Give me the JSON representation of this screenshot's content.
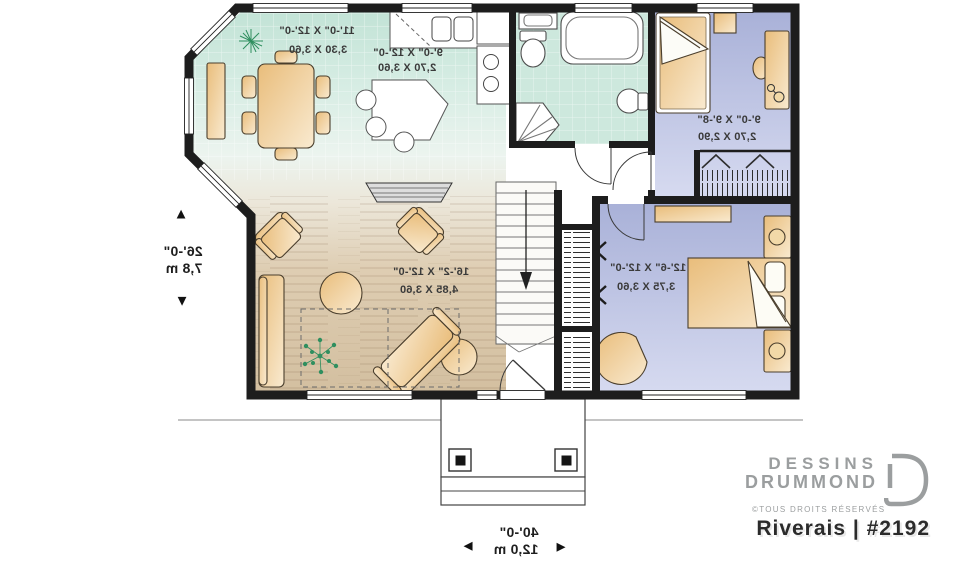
{
  "plan": {
    "rooms": {
      "dining": {
        "imperial": "11'-0\" X 12'-0\"",
        "metric": "3,30 X 3,60"
      },
      "kitchen": {
        "imperial": "9'-0\" X 12'-0\"",
        "metric": "2,70 X 3,60"
      },
      "bedroom2": {
        "imperial": "9'-0\" X 9'-8\"",
        "metric": "2,70 X 2,90"
      },
      "living": {
        "imperial": "16'-2\" X 12'-0\"",
        "metric": "4,85 X 3,60"
      },
      "master": {
        "imperial": "12'-6\" X 12'-0\"",
        "metric": "3,75 X 3,60"
      }
    },
    "dimensions": {
      "depth_imperial": "26'-0\"",
      "depth_metric": "7,8 m",
      "width_imperial": "40'-0\"",
      "width_metric": "12,0 m"
    }
  },
  "icons": {
    "arrow_up": "▲",
    "arrow_down": "▼",
    "arrow_left": "◄",
    "arrow_right": "►"
  },
  "branding": {
    "line1": "DESSINS",
    "line2": "DRUMMOND",
    "rights": "©TOUS DROITS RÉSERVÉS",
    "plan_name": "Riverais | #2192"
  },
  "colors": {
    "wall": "#1d1d1d",
    "tile_floor": "#c6e5d9",
    "wood_floor": "#d6c2a4",
    "bedroom_floor": "#b2b9dc",
    "furniture": "#eec287",
    "plant": "#2f8f5f",
    "logo_gray": "#9b9e9f"
  }
}
